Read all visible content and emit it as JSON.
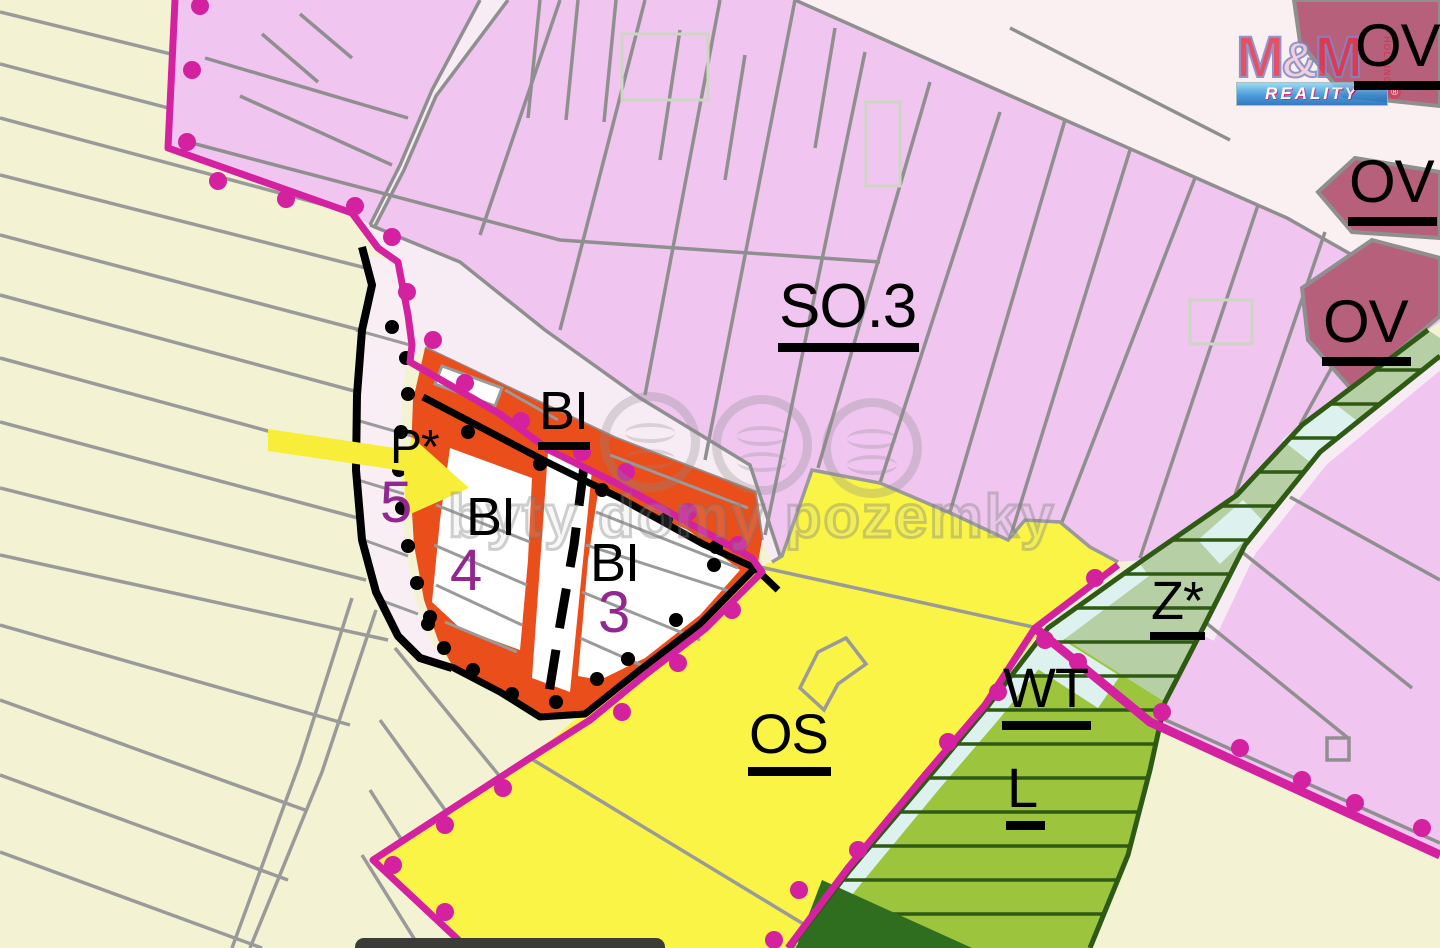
{
  "app": {
    "type": "zoning-plan-map",
    "description": "Municipal land-use plan detail"
  },
  "zone_labels": {
    "ov1": "OV",
    "ov2": "OV",
    "ov3": "OV",
    "so3": "SO.3",
    "bi_top": "BI",
    "bi_4": "BI",
    "bi_3": "BI",
    "p_star": "P*",
    "num5": "5",
    "num4": "4",
    "num3": "3",
    "os": "OS",
    "wt": "WT",
    "l": "L",
    "z_star": "Z*"
  },
  "watermark": {
    "text": "byty domy pozemky",
    "icons": [
      "house-circle-icon",
      "waves-circle-icon",
      "waves-circle-icon"
    ]
  },
  "logo": {
    "m1": "M",
    "amp": "&",
    "m2": "M",
    "reality": "REALITY",
    "holding": "HOLDING",
    "reg": "®"
  },
  "colors": {
    "residential_pink": "#f0c6f0",
    "road_light_pink": "#f8ecf4",
    "pale_top_right": "#faf0f2",
    "civic_ov_red": "#b6607b",
    "development_bi_orange": "#e94e1b",
    "sport_os_yellow": "#f9f446",
    "green_l": "#9cc43d",
    "biocorridor_z_sage": "#b6cfa4",
    "water_wt_cyan": "#ddf2ef",
    "dark_green_line": "#2e5a14",
    "boundary_magenta": "#d4219f",
    "parcel_gray": "#909090",
    "plots_cream": "#f3f3d4",
    "label_purple": "#92278f",
    "arrow_yellow": "#f8ee39"
  }
}
